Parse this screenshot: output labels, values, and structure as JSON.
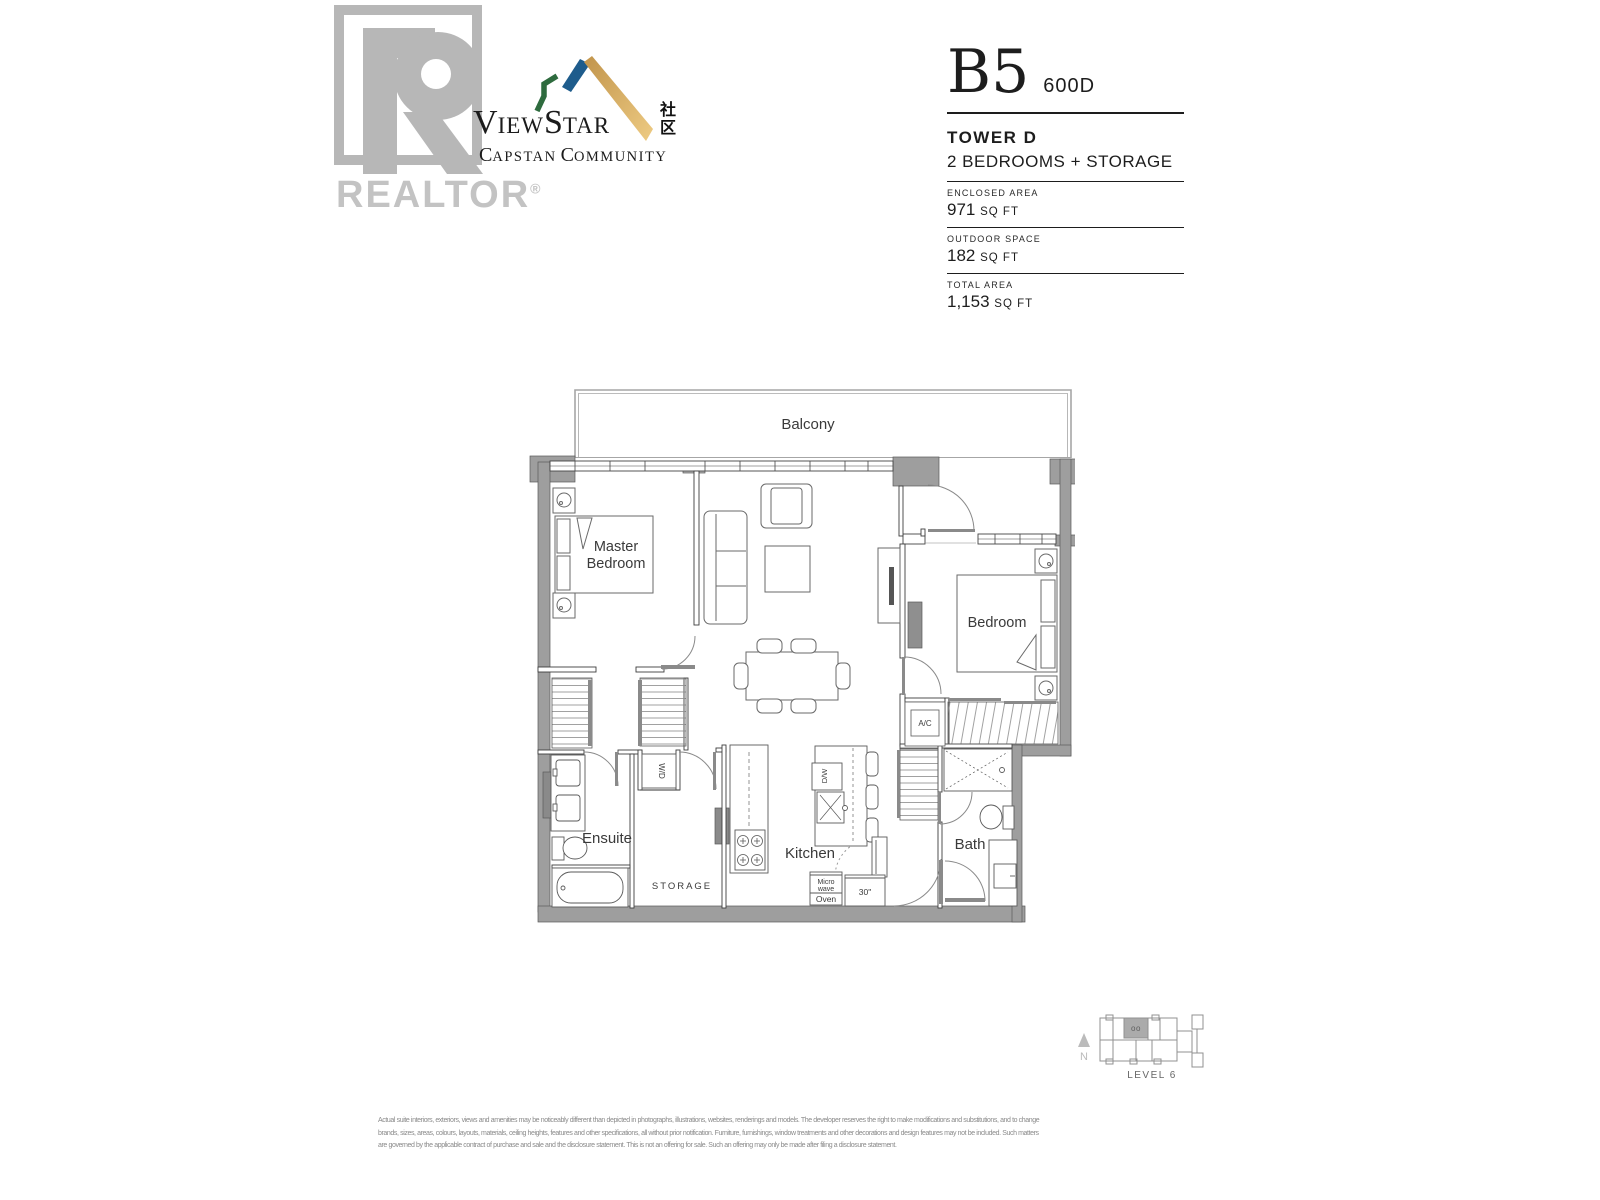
{
  "branding": {
    "realtor": {
      "wordmark": "REALTOR",
      "registered": "®"
    },
    "viewstar": {
      "v": "V",
      "iew": "IEW",
      "s": "S",
      "tar": "TAR",
      "chinese_top": "社",
      "chinese_bottom": "区",
      "c1": "C",
      "apstan": "APSTAN",
      "c2": "C",
      "ommunity": "OMMUNITY"
    },
    "colors": {
      "roof_green": "#2e6b3e",
      "roof_blue": "#1e5c8c",
      "roof_gold": "#d9a95c",
      "watermark_gray": "#b7b7b7"
    }
  },
  "unit": {
    "plan_code": "B5",
    "unit_number": "600D",
    "tower": "TOWER D",
    "description": "2 BEDROOMS + STORAGE",
    "areas": [
      {
        "label": "ENCLOSED AREA",
        "value": "971",
        "unit": "SQ FT"
      },
      {
        "label": "OUTDOOR SPACE",
        "value": "182",
        "unit": "SQ FT"
      },
      {
        "label": "TOTAL AREA",
        "value": "1,153",
        "unit": "SQ FT"
      }
    ]
  },
  "floorplan": {
    "labels": {
      "balcony": "Balcony",
      "master_line1": "Master",
      "master_line2": "Bedroom",
      "bedroom": "Bedroom",
      "ensuite": "Ensuite",
      "storage": "STORAGE",
      "kitchen": "Kitchen",
      "bath": "Bath",
      "wd": "W/D",
      "dw": "D/W",
      "ac": "A/C",
      "micro_line1": "Micro",
      "micro_line2": "wave",
      "micro_line3": "Oven",
      "fridge": "30\""
    },
    "wall_color": "#9e9e9e"
  },
  "keyplan": {
    "level": "LEVEL 6",
    "north": "N",
    "unit_marker": "oo"
  },
  "disclaimer": [
    "Actual suite interiors, exteriors, views and amenities may be noticeably different than depicted in photographs, illustrations, websites, renderings and models.  The developer reserves the right to make modifications and substitutions, and to change",
    "brands, sizes, areas, colours, layouts, materials, ceiling heights, features and other specifications, all without prior notification.  Furniture, furnishings, window treatments and other decorations and design features may not be included.  Such matters",
    "are governed by the applicable contract of purchase and sale and the disclosure statement. This is not an offering for sale. Such an offering may only be made after filing a disclosure statement."
  ]
}
